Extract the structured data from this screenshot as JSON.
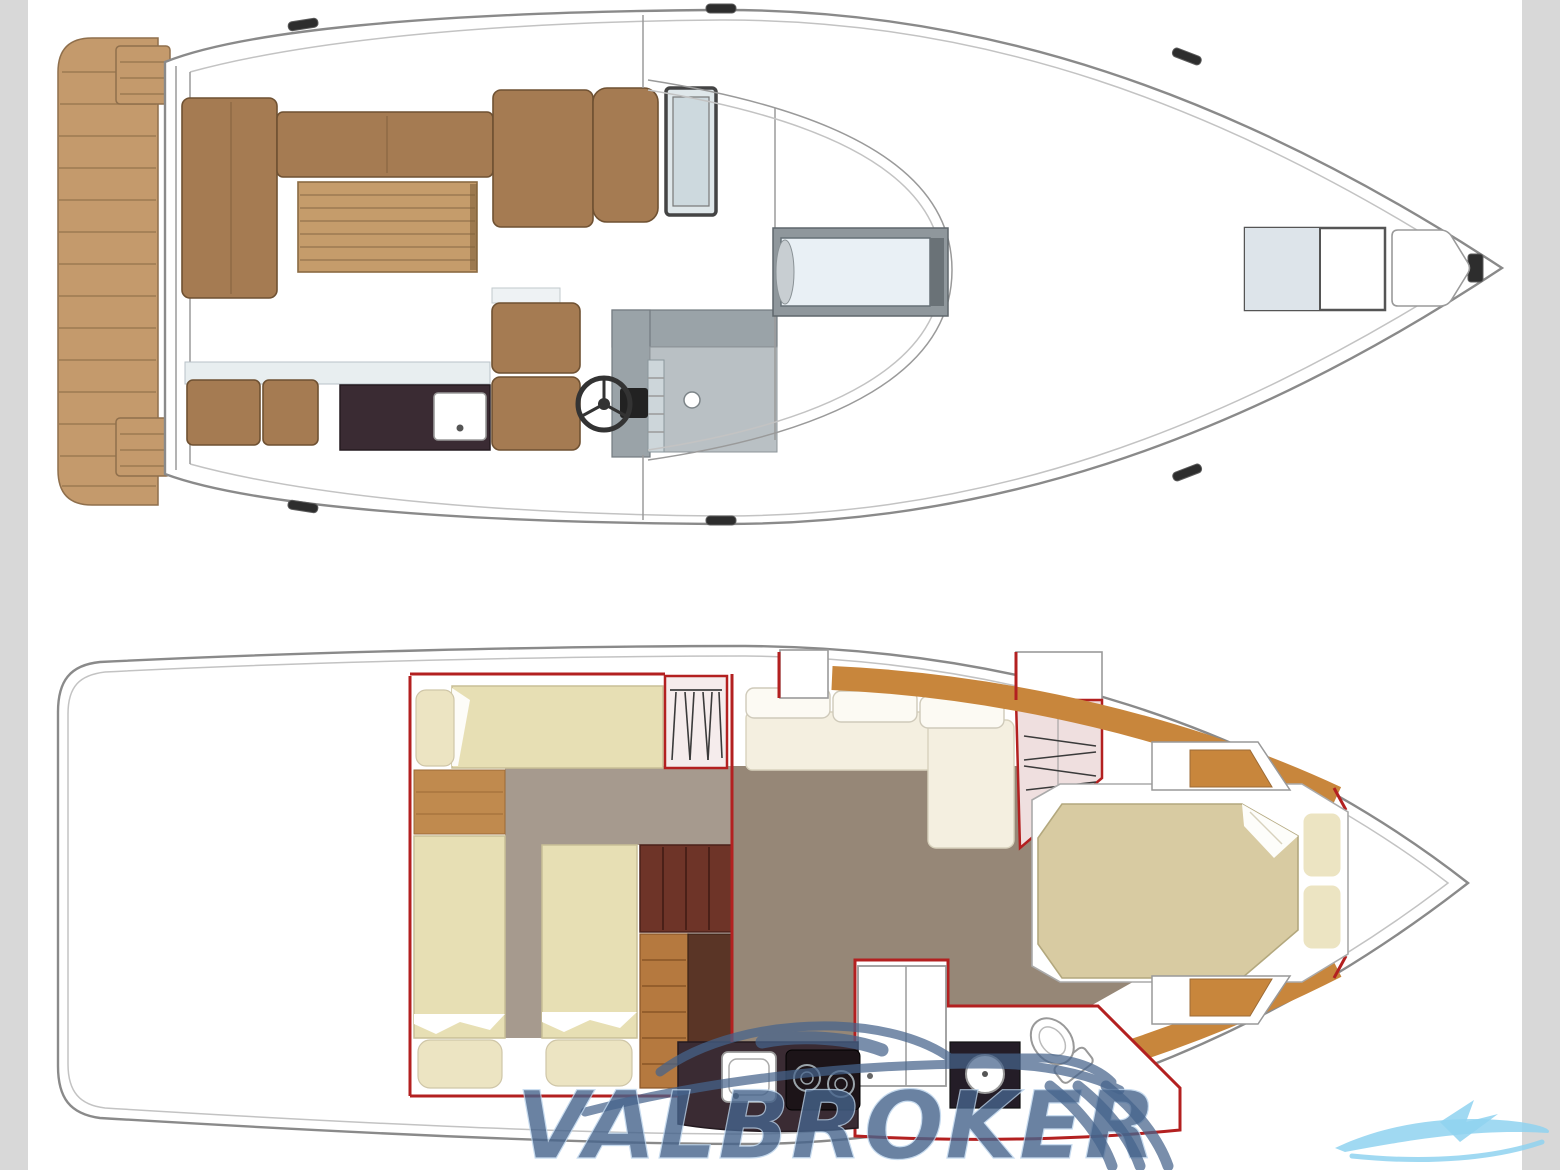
{
  "watermark": {
    "text": "VALBROKER"
  },
  "plans": {
    "upper": {
      "name": "main deck plan"
    },
    "lower": {
      "name": "lower deck cabin plan"
    }
  },
  "colors": {
    "side_band": "#d8d8d8",
    "hull_line": "#8a8a8a",
    "teak": "#c49a6c",
    "teak_line": "#9b7a52",
    "upholstery": "#a57b52",
    "upholstery_dark": "#6f5132",
    "table_wood": "#c59c6b",
    "counter_dark": "#3a2b33",
    "seat_base": "#e8eef0",
    "console_gray": "#9aa3a8",
    "console_light": "#b9c0c4",
    "glass": "#e9f0f5",
    "sunpad": "#dde4ea",
    "carpet_guest": "#a69a8e",
    "carpet_salon": "#968777",
    "berth": "#e7dfb4",
    "pillow": "#ece4c2",
    "wood_floor": "#c08a4e",
    "wood_rim": "#c8863c",
    "steps_dark": "#6e3428",
    "steps_wood": "#b5793f",
    "walnut": "#5a3526",
    "partition_red": "#b32020",
    "wardrobe": "#efdfdf",
    "sofa_cream": "#f4efe0",
    "sofa_white": "#fcfaf3",
    "bed": "#d8cba2",
    "stove_black": "#1c1418",
    "watermark_blue": "#46648c",
    "logo_light_blue": "#8fd2f0"
  }
}
